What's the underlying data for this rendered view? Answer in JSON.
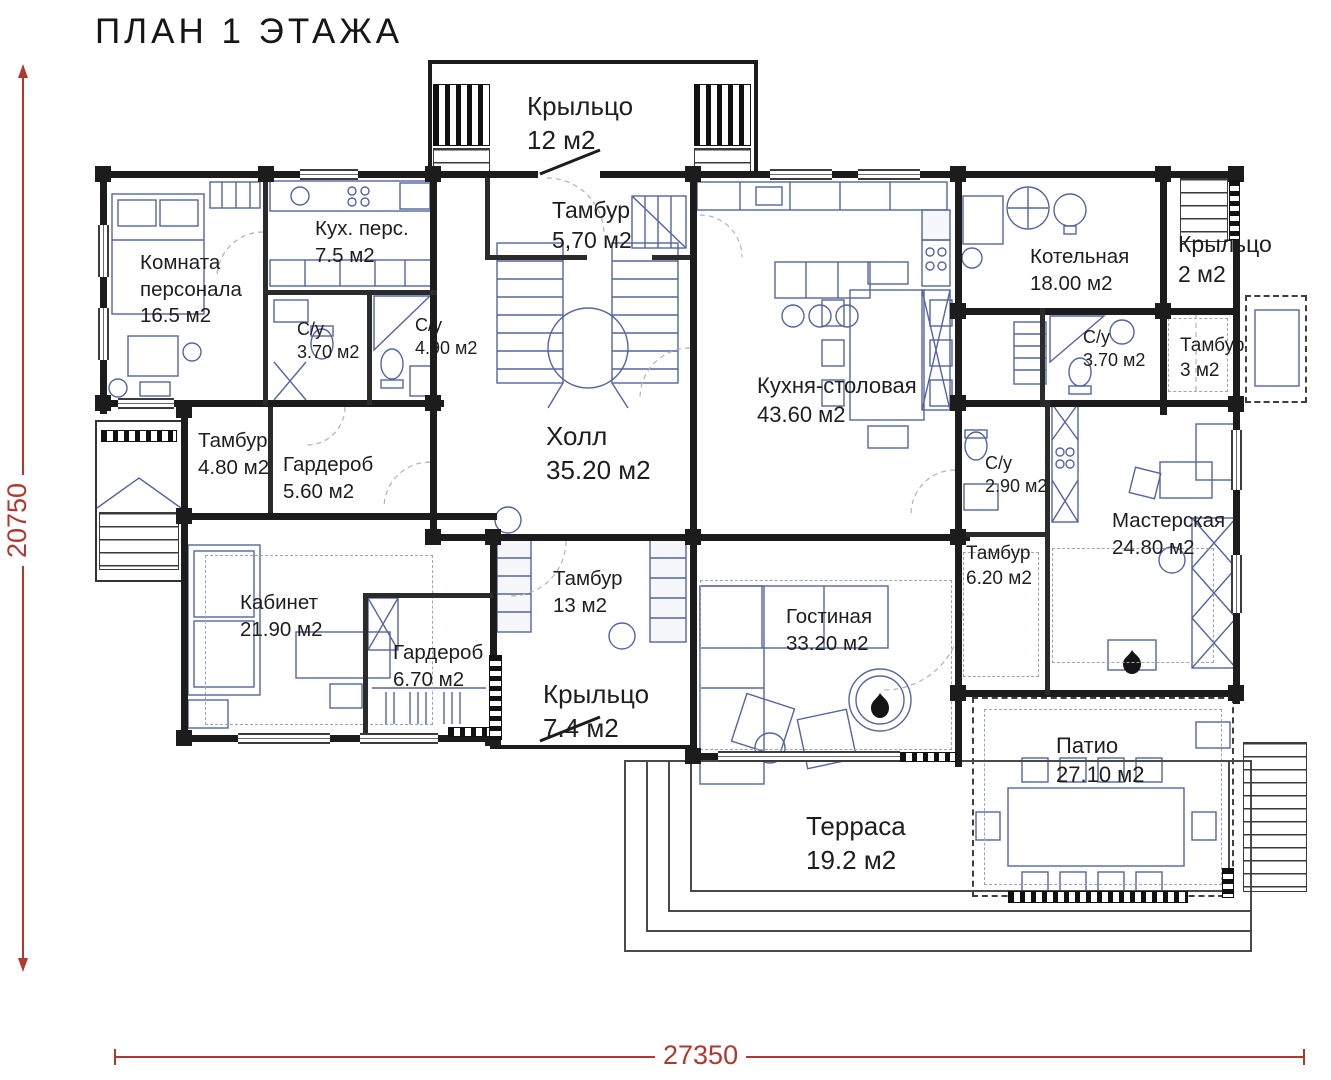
{
  "title": "ПЛАН 1 ЭТАЖА",
  "dimensions": {
    "height_label": "20750",
    "width_label": "27350"
  },
  "colors": {
    "wall": "#1c1c1c",
    "furniture": "#5365a0",
    "dimension": "#b0392f",
    "label": "#1e1e1e"
  },
  "rooms": [
    {
      "name": "Крыльцо",
      "area": "12 м2"
    },
    {
      "name": "Тамбур",
      "area": "5,70 м2"
    },
    {
      "name": "Кух. перс.",
      "area": "7.5 м2"
    },
    {
      "name": "Комната персонала",
      "area": "16.5 м2"
    },
    {
      "name": "С/у",
      "area": "3.70 м2"
    },
    {
      "name": "С/у",
      "area": "4.90 м2"
    },
    {
      "name": "Котельная",
      "area": "18.00 м2"
    },
    {
      "name": "Крыльцо",
      "area": "2 м2"
    },
    {
      "name": "С/у",
      "area": "3.70 м2"
    },
    {
      "name": "Тамбур",
      "area": "3 м2"
    },
    {
      "name": "Кухня-столовая",
      "area": "43.60 м2"
    },
    {
      "name": "Холл",
      "area": "35.20 м2"
    },
    {
      "name": "Тамбур",
      "area": "4.80 м2"
    },
    {
      "name": "Гардероб",
      "area": "5.60 м2"
    },
    {
      "name": "С/у",
      "area": "2.90 м2"
    },
    {
      "name": "Мастерская",
      "area": "24.80 м2"
    },
    {
      "name": "Тамбур",
      "area": "6.20 м2"
    },
    {
      "name": "Кабинет",
      "area": "21.90 м2"
    },
    {
      "name": "Тамбур",
      "area": "13 м2"
    },
    {
      "name": "Гостиная",
      "area": "33.20 м2"
    },
    {
      "name": "Гардероб",
      "area": "6.70 м2"
    },
    {
      "name": "Крыльцо",
      "area": "7.4 м2"
    },
    {
      "name": "Патио",
      "area": "27.10 м2"
    },
    {
      "name": "Терраса",
      "area": "19.2 м2"
    }
  ]
}
